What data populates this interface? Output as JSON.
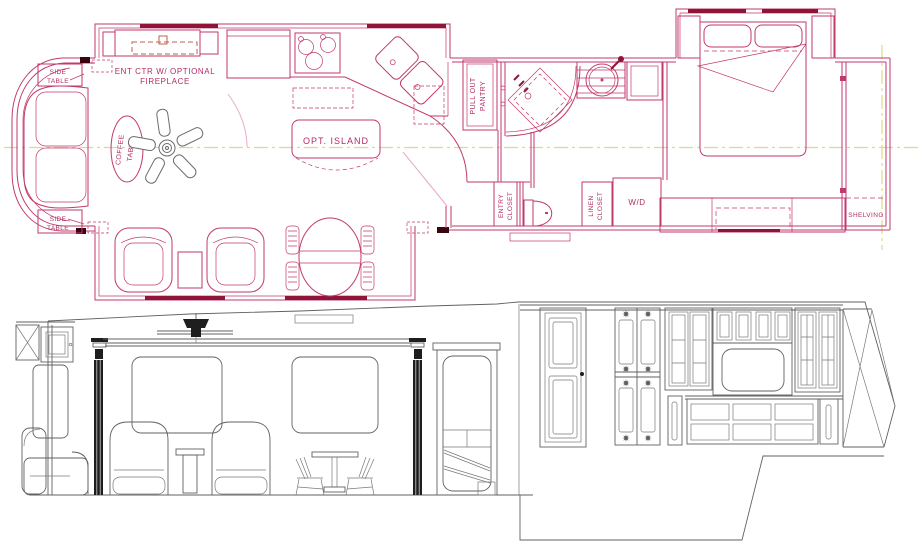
{
  "drawing": {
    "type": "rv-floorplan-and-elevation",
    "colors": {
      "plan_line": "#C23A6C",
      "plan_bold": "#8E1537",
      "plan_light_pink": "#E9AACB",
      "fireplace_dash": "#C0614F",
      "centerline_yellow": "#DCDC85",
      "elevation_line": "#616161",
      "elevation_dark": "#1E1E1E",
      "label_text": "#B02D62"
    }
  },
  "floor_plan": {
    "labels": {
      "side_table_top_1": "SIDE",
      "side_table_top_2": "TABLE",
      "ent_ctr_1": "ENT CTR W/ OPTIONAL",
      "ent_ctr_2": "FIREPLACE",
      "coffee_1": "COFFEE",
      "coffee_2": "TABLE",
      "opt_island": "OPT. ISLAND",
      "pantry_1": "PULL OUT",
      "pantry_2": "PANTRY",
      "entry_closet_1": "ENTRY",
      "entry_closet_2": "CLOSET",
      "linen_1": "LINEN",
      "linen_2": "CLOSET",
      "wd": "W/D",
      "shelving": "SHELVING",
      "side_table_bot_1": "SIDE",
      "side_table_bot_2": "TABLE"
    }
  }
}
